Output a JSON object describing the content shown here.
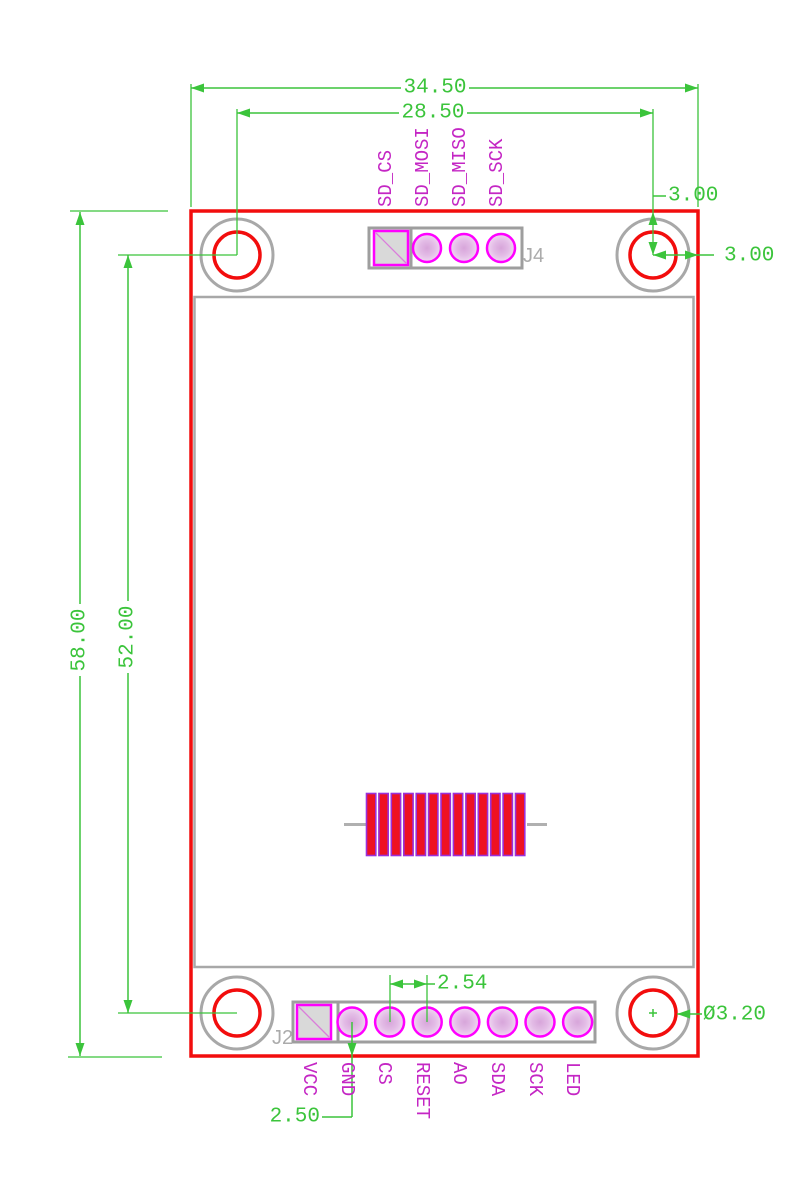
{
  "drawing": {
    "type": "pcb-dimension-drawing",
    "dims": {
      "overall_width": "34.50",
      "hole_span_width": "28.50",
      "overall_height": "58.00",
      "hole_span_height": "52.00",
      "hole_offset_top": "3.00",
      "hole_offset_right": "3.00",
      "pin_pitch": "2.54",
      "pin_to_edge": "2.50",
      "hole_diameter": "Ø3.20"
    },
    "connectors": {
      "j4": {
        "ref": "J4",
        "pins": [
          "SD_CS",
          "SD_MOSI",
          "SD_MISO",
          "SD_SCK"
        ]
      },
      "j2": {
        "ref": "J2",
        "pins": [
          "VCC",
          "GND",
          "CS",
          "RESET",
          "AO",
          "SDA",
          "SCK",
          "LED"
        ]
      }
    },
    "colors": {
      "dimension_green": "#3bc43b",
      "board_outline_red": "#f20d0d",
      "silkscreen_gray": "#a8a8a8",
      "pad_magenta": "#ff00ff",
      "pin_label_magenta": "#c426c4"
    }
  }
}
